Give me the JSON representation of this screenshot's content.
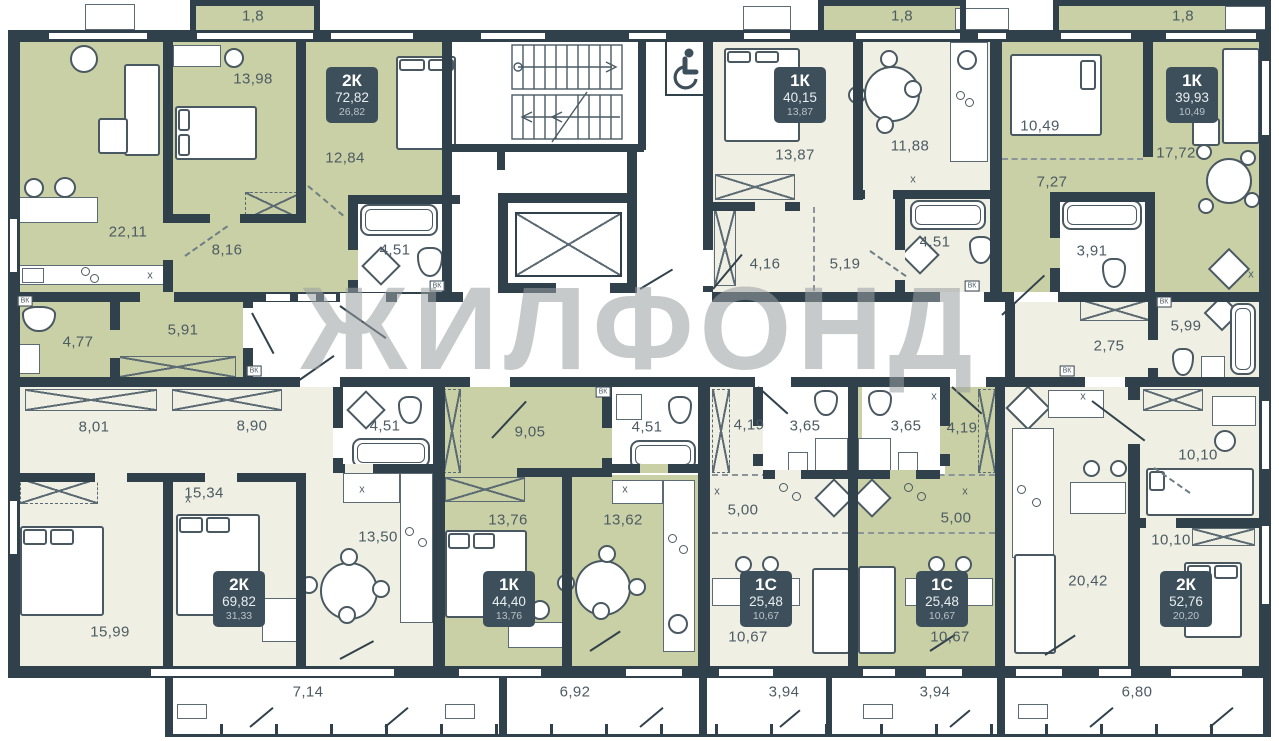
{
  "watermark": "ЖИЛФОНД",
  "marker_text": "x",
  "vk_text": "ВК",
  "colors": {
    "wall": "#31414c",
    "olive": "#c9d0a5",
    "cream": "#eff0e3",
    "badge": "#3d4f5b",
    "label": "#4d5b64",
    "wm": "#9aa0a2"
  },
  "apartments": [
    {
      "type": "2К",
      "total": "72,82",
      "living": "26,82",
      "x": 352,
      "y": 95
    },
    {
      "type": "1К",
      "total": "40,15",
      "living": "13,87",
      "x": 800,
      "y": 95
    },
    {
      "type": "1К",
      "total": "39,93",
      "living": "10,49",
      "x": 1192,
      "y": 95
    },
    {
      "type": "2К",
      "total": "69,82",
      "living": "31,33",
      "x": 239,
      "y": 599
    },
    {
      "type": "1К",
      "total": "44,40",
      "living": "13,76",
      "x": 509,
      "y": 599
    },
    {
      "type": "1С",
      "total": "25,48",
      "living": "10,67",
      "x": 766,
      "y": 599
    },
    {
      "type": "1С",
      "total": "25,48",
      "living": "10,67",
      "x": 942,
      "y": 599
    },
    {
      "type": "2К",
      "total": "52,76",
      "living": "20,20",
      "x": 1186,
      "y": 599
    }
  ],
  "room_labels": [
    {
      "t": "22,11",
      "x": 128,
      "y": 232
    },
    {
      "t": "13,98",
      "x": 253,
      "y": 79
    },
    {
      "t": "12,84",
      "x": 345,
      "y": 158
    },
    {
      "t": "8,16",
      "x": 227,
      "y": 250
    },
    {
      "t": "4,51",
      "x": 395,
      "y": 250
    },
    {
      "t": "4,77",
      "x": 78,
      "y": 342
    },
    {
      "t": "5,91",
      "x": 183,
      "y": 330
    },
    {
      "t": "13,87",
      "x": 795,
      "y": 155
    },
    {
      "t": "11,88",
      "x": 910,
      "y": 146
    },
    {
      "t": "4,16",
      "x": 765,
      "y": 264
    },
    {
      "t": "5,19",
      "x": 845,
      "y": 264
    },
    {
      "t": "4,51",
      "x": 935,
      "y": 242
    },
    {
      "t": "10,49",
      "x": 1040,
      "y": 126
    },
    {
      "t": "7,27",
      "x": 1052,
      "y": 182
    },
    {
      "t": "17,72",
      "x": 1176,
      "y": 153
    },
    {
      "t": "3,91",
      "x": 1092,
      "y": 251
    },
    {
      "t": "5,99",
      "x": 1186,
      "y": 326
    },
    {
      "t": "2,75",
      "x": 1109,
      "y": 346
    },
    {
      "t": "8,01",
      "x": 94,
      "y": 427
    },
    {
      "t": "8,90",
      "x": 252,
      "y": 426
    },
    {
      "t": "4,51",
      "x": 385,
      "y": 426
    },
    {
      "t": "15,34",
      "x": 204,
      "y": 493
    },
    {
      "t": "13,50",
      "x": 378,
      "y": 537
    },
    {
      "t": "15,99",
      "x": 110,
      "y": 632
    },
    {
      "t": "9,05",
      "x": 530,
      "y": 432
    },
    {
      "t": "4,51",
      "x": 647,
      "y": 427
    },
    {
      "t": "13,76",
      "x": 508,
      "y": 520
    },
    {
      "t": "13,62",
      "x": 623,
      "y": 520
    },
    {
      "t": "4,19",
      "x": 749,
      "y": 425
    },
    {
      "t": "3,65",
      "x": 805,
      "y": 426
    },
    {
      "t": "5,00",
      "x": 743,
      "y": 510
    },
    {
      "t": "10,67",
      "x": 748,
      "y": 637
    },
    {
      "t": "3,65",
      "x": 906,
      "y": 426
    },
    {
      "t": "4,19",
      "x": 962,
      "y": 428
    },
    {
      "t": "5,00",
      "x": 956,
      "y": 518
    },
    {
      "t": "10,67",
      "x": 950,
      "y": 637
    },
    {
      "t": "20,42",
      "x": 1088,
      "y": 581
    },
    {
      "t": "10,10",
      "x": 1198,
      "y": 455
    },
    {
      "t": "10,10",
      "x": 1171,
      "y": 540
    }
  ],
  "balcony_labels": [
    {
      "t": "1,8",
      "x": 253,
      "y": 16
    },
    {
      "t": "1,8",
      "x": 902,
      "y": 16
    },
    {
      "t": "1,8",
      "x": 1183,
      "y": 16
    },
    {
      "t": "7,14",
      "x": 308,
      "y": 692
    },
    {
      "t": "6,92",
      "x": 575,
      "y": 692
    },
    {
      "t": "3,94",
      "x": 784,
      "y": 692
    },
    {
      "t": "3,94",
      "x": 935,
      "y": 692
    },
    {
      "t": "6,80",
      "x": 1137,
      "y": 692
    }
  ],
  "x_markers": [
    {
      "x": 150,
      "y": 276
    },
    {
      "x": 913,
      "y": 180
    },
    {
      "x": 1251,
      "y": 275
    },
    {
      "x": 188,
      "y": 500
    },
    {
      "x": 362,
      "y": 490
    },
    {
      "x": 625,
      "y": 490
    },
    {
      "x": 717,
      "y": 492
    },
    {
      "x": 965,
      "y": 492
    },
    {
      "x": 934,
      "y": 397
    },
    {
      "x": 1083,
      "y": 397
    }
  ],
  "vk_boxes": [
    {
      "x": 25,
      "y": 301
    },
    {
      "x": 254,
      "y": 371
    },
    {
      "x": 437,
      "y": 286
    },
    {
      "x": 603,
      "y": 392
    },
    {
      "x": 972,
      "y": 286
    },
    {
      "x": 1067,
      "y": 371
    },
    {
      "x": 1164,
      "y": 302
    }
  ]
}
